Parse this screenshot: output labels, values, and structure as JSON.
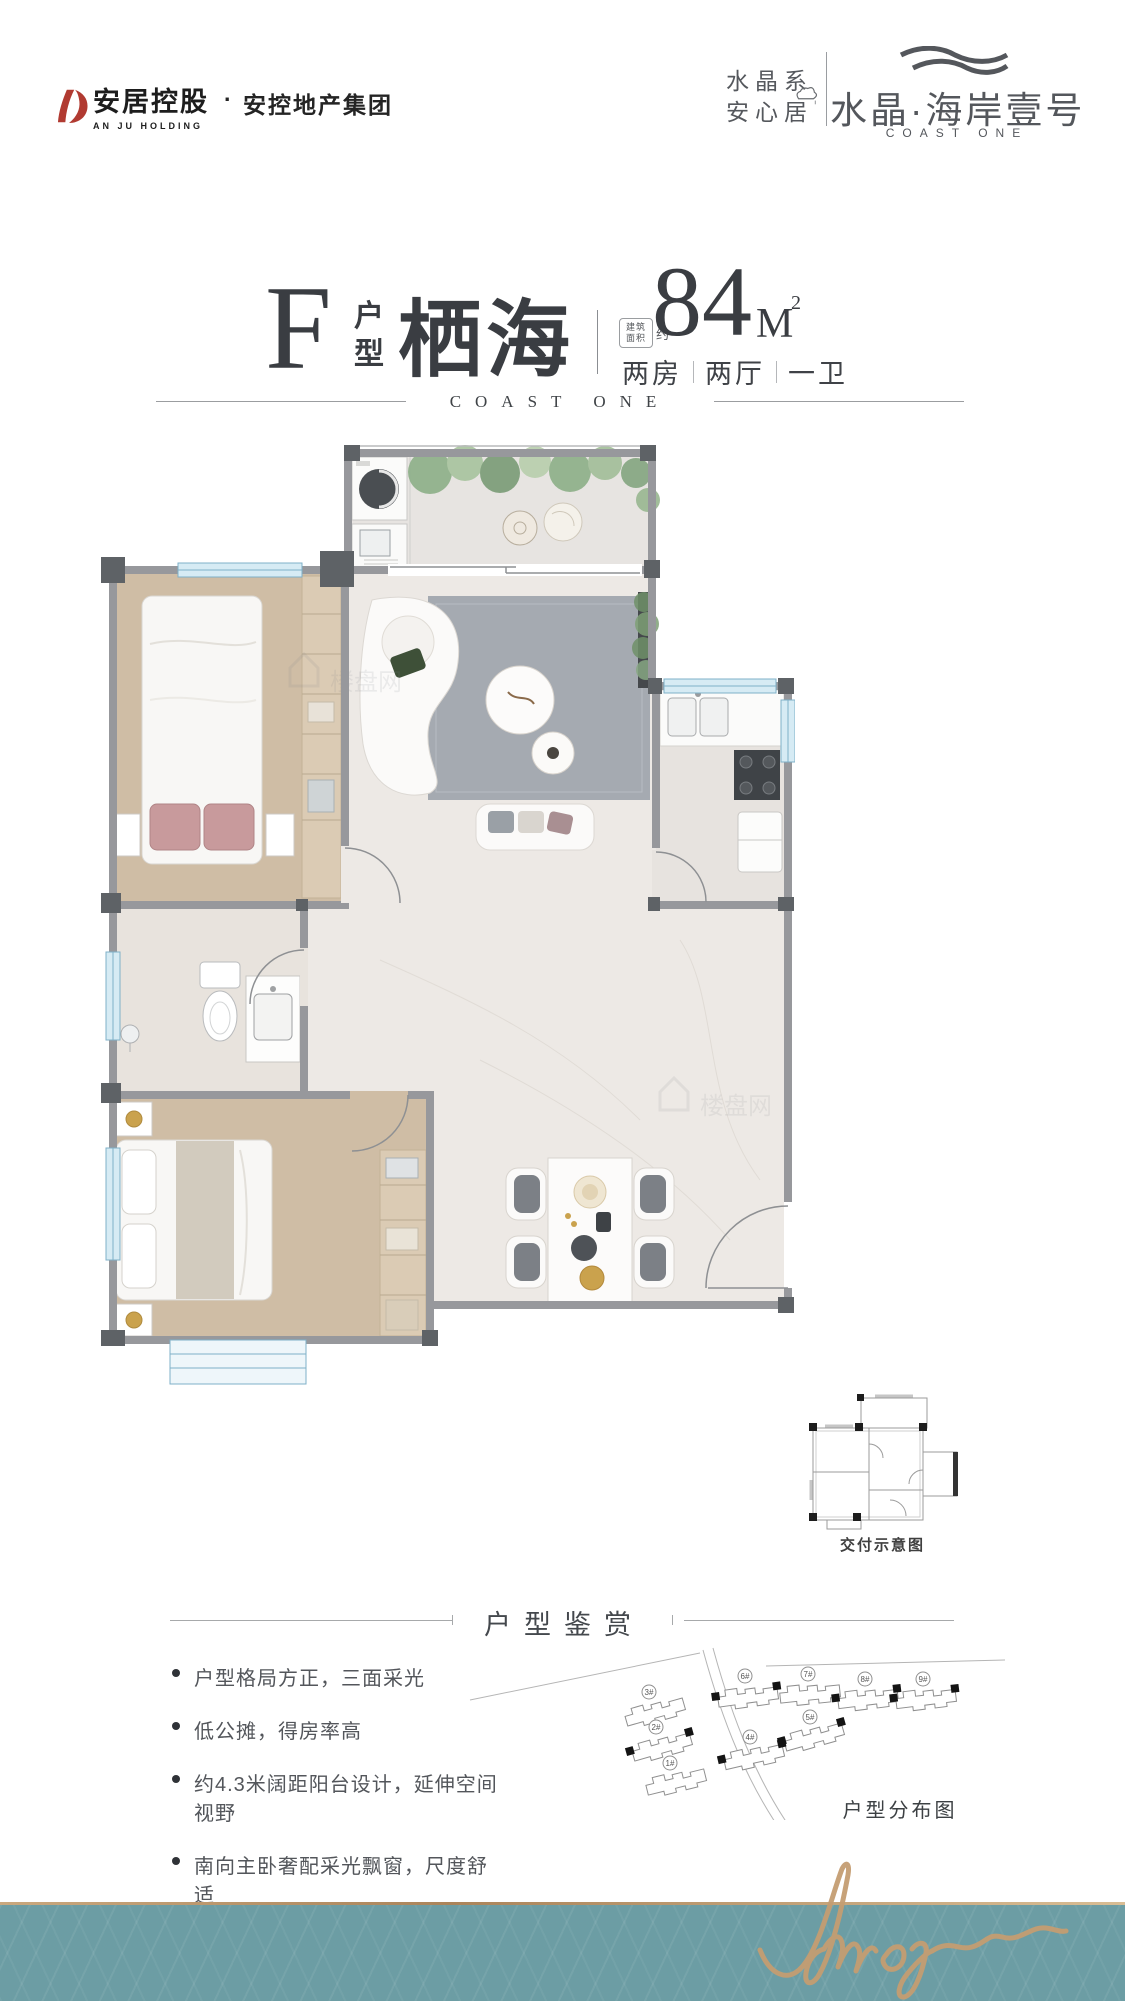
{
  "colors": {
    "accent_red": "#b13a31",
    "ink": "#3a3d42",
    "muted": "#54575c",
    "wall": "#97989c",
    "teal_band": "#6c9da4",
    "gold": "#c49d72",
    "window_teal": "#7fb0c8"
  },
  "header": {
    "logo": {
      "cn": "安居控股",
      "en": "AN JU HOLDING",
      "dot": "·",
      "group": "安控地产集团"
    },
    "brand": {
      "series_top": "水晶系",
      "series_bottom": "安心居",
      "project": "水晶·海岸壹号",
      "project_en": "COAST ONE"
    }
  },
  "title": {
    "letter": "F",
    "label_top": "户",
    "label_bottom": "型",
    "name": "栖海",
    "area_tag_1": "建筑",
    "area_tag_2": "面积",
    "area_tag_3": "约",
    "area_value": "84",
    "area_unit": "M",
    "area_sup": "2",
    "layout": [
      "两房",
      "两厅",
      "一卫"
    ],
    "en": "COAST ONE"
  },
  "floorplan": {
    "watermark": "楼盘网"
  },
  "delivery": {
    "caption": "交付示意图"
  },
  "notes": {
    "heading": "户型鉴赏",
    "bullets": [
      "户型格局方正，三面采光",
      "低公摊，得房率高",
      "约4.3米阔距阳台设计，延伸空间视野",
      "南向主卧奢配采光飘窗，尺度舒适"
    ]
  },
  "siteplan": {
    "caption": "户型分布图",
    "buildings": [
      {
        "label": "1#",
        "marked": false
      },
      {
        "label": "2#",
        "marked": true
      },
      {
        "label": "3#",
        "marked": false
      },
      {
        "label": "4#",
        "marked": true
      },
      {
        "label": "5#",
        "marked": true
      },
      {
        "label": "6#",
        "marked": true
      },
      {
        "label": "7#",
        "marked": false
      },
      {
        "label": "8#",
        "marked": true
      },
      {
        "label": "9#",
        "marked": true
      }
    ]
  },
  "footer": {
    "signature": "Amoy"
  }
}
